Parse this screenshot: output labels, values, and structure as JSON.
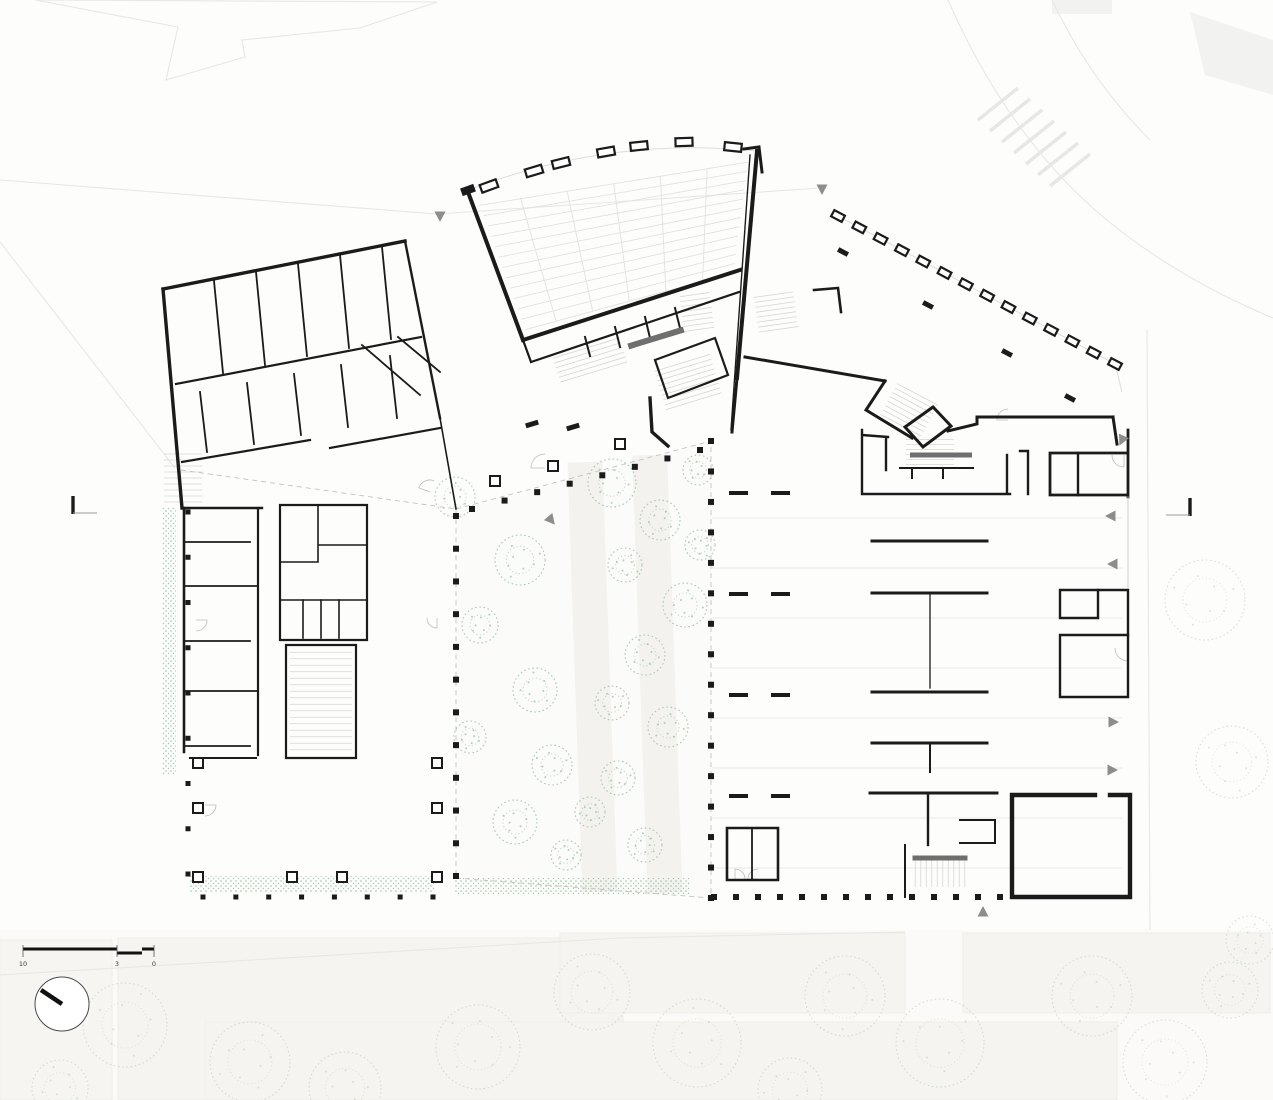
{
  "meta": {
    "drawing_type": "architectural-ground-floor-plan",
    "description": "Black-line floor plan with auditorium, classroom wings, planted courtyard, colonnades and parking hall"
  },
  "colors": {
    "wall": "#1b1b1b",
    "thin_wall": "#2a2a2a",
    "context_line": "#e7e7e4",
    "context_fill": "#f5f4f0",
    "floor_line": "#e9e9e6",
    "stair_line": "#d6d6d2",
    "dashed_line": "#c3c3bf",
    "vegetation": "#9cc2a6",
    "vegetation_dot": "#8fbc9b",
    "arrow": "#8d8d8d",
    "ramp": "#6f6f6f",
    "paper": "#fdfdfc"
  },
  "scale_bar": {
    "labels": [
      "10",
      "3",
      "0"
    ]
  },
  "north_arrow": {
    "cx": 62,
    "cy": 1004,
    "r": 27,
    "needle_x": 41,
    "needle_y": 990
  },
  "section_markers": [
    {
      "x": 73,
      "y": 496,
      "dir": 1
    },
    {
      "x": 1190,
      "y": 498,
      "dir": -1
    }
  ],
  "seating": {
    "quad": [
      [
        470,
        195
      ],
      [
        755,
        153
      ],
      [
        738,
        282
      ],
      [
        523,
        340
      ]
    ],
    "rows": 13,
    "aisles": 5
  },
  "clerestory": {
    "w": 17,
    "h": 8,
    "rects": [
      [
        489,
        186,
        -20
      ],
      [
        534,
        171,
        -17
      ],
      [
        561,
        163,
        -14
      ],
      [
        606,
        152,
        -10
      ],
      [
        639,
        146,
        -6
      ],
      [
        684,
        142,
        -2
      ],
      [
        733,
        147,
        6
      ]
    ]
  },
  "solid_rects": [
    [
      468,
      190,
      -20,
      14,
      8
    ]
  ],
  "colonnades": [
    {
      "x1": 456,
      "y1": 516,
      "x2": 456,
      "y2": 876,
      "n": 12,
      "s": 6
    },
    {
      "x1": 472,
      "y1": 509,
      "x2": 700,
      "y2": 450,
      "n": 8,
      "s": 6
    },
    {
      "x1": 711,
      "y1": 441,
      "x2": 711,
      "y2": 898,
      "n": 16,
      "s": 6
    },
    {
      "x1": 714,
      "y1": 897,
      "x2": 1000,
      "y2": 897,
      "n": 14,
      "s": 6
    },
    {
      "x1": 188,
      "y1": 512,
      "x2": 188,
      "y2": 874,
      "n": 9,
      "s": 5
    },
    {
      "x1": 203,
      "y1": 897,
      "x2": 433,
      "y2": 897,
      "n": 8,
      "s": 5
    }
  ],
  "piers": [
    [
      198,
      763
    ],
    [
      198,
      808
    ],
    [
      198,
      877
    ],
    [
      292,
      877
    ],
    [
      342,
      877
    ],
    [
      437,
      763
    ],
    [
      437,
      808
    ],
    [
      437,
      877
    ],
    [
      495,
      481
    ],
    [
      553,
      466
    ],
    [
      620,
      444
    ]
  ],
  "foyer_colonnade": {
    "x1": 838,
    "y1": 216,
    "x2": 1115,
    "y2": 364,
    "n": 14,
    "w": 12,
    "h": 7,
    "tilt": 28
  },
  "lone_columns": {
    "tilt": 28,
    "w": 11,
    "h": 5,
    "pts": [
      [
        843,
        252
      ],
      [
        928,
        305
      ],
      [
        1007,
        353
      ],
      [
        1070,
        398
      ]
    ]
  },
  "entry_stubs": {
    "tilt": -17,
    "w": 13,
    "h": 5,
    "pts": [
      [
        532,
        424
      ],
      [
        573,
        427
      ]
    ]
  },
  "party_stubs": [
    [
      729,
      493,
      748,
      493
    ],
    [
      771,
      493,
      790,
      493
    ],
    [
      729,
      594,
      748,
      594
    ],
    [
      771,
      594,
      790,
      594
    ],
    [
      729,
      695,
      748,
      695
    ],
    [
      771,
      695,
      790,
      695
    ],
    [
      729,
      796,
      748,
      796
    ],
    [
      771,
      796,
      790,
      796
    ]
  ],
  "stairs": [
    {
      "cx": 183,
      "cy": 478,
      "len": 38,
      "count": 9,
      "gap": 6,
      "angle": 0
    },
    {
      "cx": 321,
      "cy": 701,
      "len": 62,
      "count": 16,
      "gap": 6.5,
      "angle": 0
    },
    {
      "cx": 697,
      "cy": 312,
      "len": 30,
      "count": 8,
      "gap": 5,
      "angle": -8
    },
    {
      "cx": 776,
      "cy": 312,
      "len": 40,
      "count": 8,
      "gap": 5,
      "angle": -8
    },
    {
      "cx": 908,
      "cy": 412,
      "len": 46,
      "count": 9,
      "gap": 5,
      "angle": 28
    },
    {
      "cx": 688,
      "cy": 382,
      "len": 58,
      "count": 9,
      "gap": 5,
      "angle": -17
    },
    {
      "cx": 590,
      "cy": 360,
      "len": 70,
      "count": 6,
      "gap": 5,
      "angle": -17
    },
    {
      "cx": 940,
      "cy": 873,
      "len": 28,
      "count": 10,
      "gap": 5.5,
      "angle": 90
    },
    {
      "cx": 930,
      "cy": 452,
      "len": 48,
      "count": 6,
      "gap": 5,
      "angle": 0
    }
  ],
  "ramps": [
    {
      "cx": 941,
      "cy": 455,
      "w": 62,
      "h": 5,
      "rot": 0
    },
    {
      "cx": 940,
      "cy": 858,
      "w": 55,
      "h": 5,
      "rot": 0
    },
    {
      "cx": 656,
      "cy": 338,
      "w": 58,
      "h": 6,
      "rot": -17
    }
  ],
  "door_arcs": [
    {
      "x": 545,
      "y": 468,
      "r": 14,
      "a0": 180,
      "a1": 270
    },
    {
      "x": 430,
      "y": 492,
      "r": 12,
      "a0": 200,
      "a1": 290
    },
    {
      "x": 1128,
      "y": 648,
      "r": 13,
      "a0": 90,
      "a1": 180
    },
    {
      "x": 1124,
      "y": 455,
      "r": 12,
      "a0": 90,
      "a1": 180
    },
    {
      "x": 735,
      "y": 879,
      "r": 10,
      "a0": 270,
      "a1": 360
    },
    {
      "x": 758,
      "y": 879,
      "r": 10,
      "a0": 180,
      "a1": 270
    },
    {
      "x": 196,
      "y": 620,
      "r": 11,
      "a0": 0,
      "a1": 90
    },
    {
      "x": 437,
      "y": 618,
      "r": 10,
      "a0": 90,
      "a1": 180
    },
    {
      "x": 205,
      "y": 805,
      "r": 11,
      "a0": 0,
      "a1": 90
    },
    {
      "x": 1008,
      "y": 420,
      "r": 11,
      "a0": 180,
      "a1": 270
    }
  ],
  "entrance_arrows": [
    {
      "x": 440,
      "y": 216,
      "rot": 180
    },
    {
      "x": 822,
      "y": 189,
      "rot": 180
    },
    {
      "x": 1122,
      "y": 440,
      "rot": 205
    },
    {
      "x": 1111,
      "y": 516,
      "rot": 270
    },
    {
      "x": 1113,
      "y": 564,
      "rot": 270
    },
    {
      "x": 1113,
      "y": 722,
      "rot": 90
    },
    {
      "x": 1112,
      "y": 770,
      "rot": 90
    },
    {
      "x": 983,
      "y": 912,
      "rot": 0
    },
    {
      "x": 551,
      "y": 520,
      "rot": 140
    }
  ],
  "crosswalk": {
    "x": 978,
    "y": 120,
    "dx": 12,
    "dy": 11,
    "n": 7,
    "len": 40,
    "rise": 32
  },
  "faint_grid": {
    "x1": 712,
    "x2": 1122,
    "ys": [
      518,
      568,
      618,
      668,
      718,
      768,
      818,
      868
    ]
  },
  "hedges": [
    [
      190,
      876,
      245,
      16
    ],
    [
      455,
      878,
      235,
      16
    ],
    [
      162,
      507,
      14,
      268
    ]
  ],
  "trees": {
    "courtyard": [
      [
        455,
        497,
        20
      ],
      [
        520,
        560,
        25
      ],
      [
        480,
        625,
        18
      ],
      [
        535,
        690,
        22
      ],
      [
        470,
        737,
        16
      ],
      [
        552,
        765,
        20
      ],
      [
        515,
        822,
        22
      ],
      [
        566,
        855,
        15
      ],
      [
        612,
        483,
        24
      ],
      [
        660,
        520,
        20
      ],
      [
        625,
        565,
        17
      ],
      [
        685,
        605,
        22
      ],
      [
        645,
        655,
        20
      ],
      [
        612,
        703,
        17
      ],
      [
        668,
        727,
        20
      ],
      [
        618,
        778,
        17
      ],
      [
        590,
        812,
        15
      ],
      [
        645,
        845,
        17
      ],
      [
        700,
        545,
        15
      ],
      [
        698,
        470,
        15
      ]
    ],
    "context": [
      [
        125,
        1025,
        42
      ],
      [
        250,
        1062,
        40
      ],
      [
        345,
        1088,
        36
      ],
      [
        478,
        1047,
        42
      ],
      [
        592,
        992,
        38
      ],
      [
        697,
        1043,
        44
      ],
      [
        845,
        996,
        40
      ],
      [
        940,
        1043,
        44
      ],
      [
        1092,
        996,
        40
      ],
      [
        1165,
        1062,
        42
      ],
      [
        1230,
        990,
        28
      ],
      [
        60,
        1088,
        28
      ],
      [
        790,
        1090,
        32
      ],
      [
        1205,
        600,
        40
      ],
      [
        1232,
        762,
        36
      ],
      [
        1250,
        940,
        24
      ]
    ]
  }
}
